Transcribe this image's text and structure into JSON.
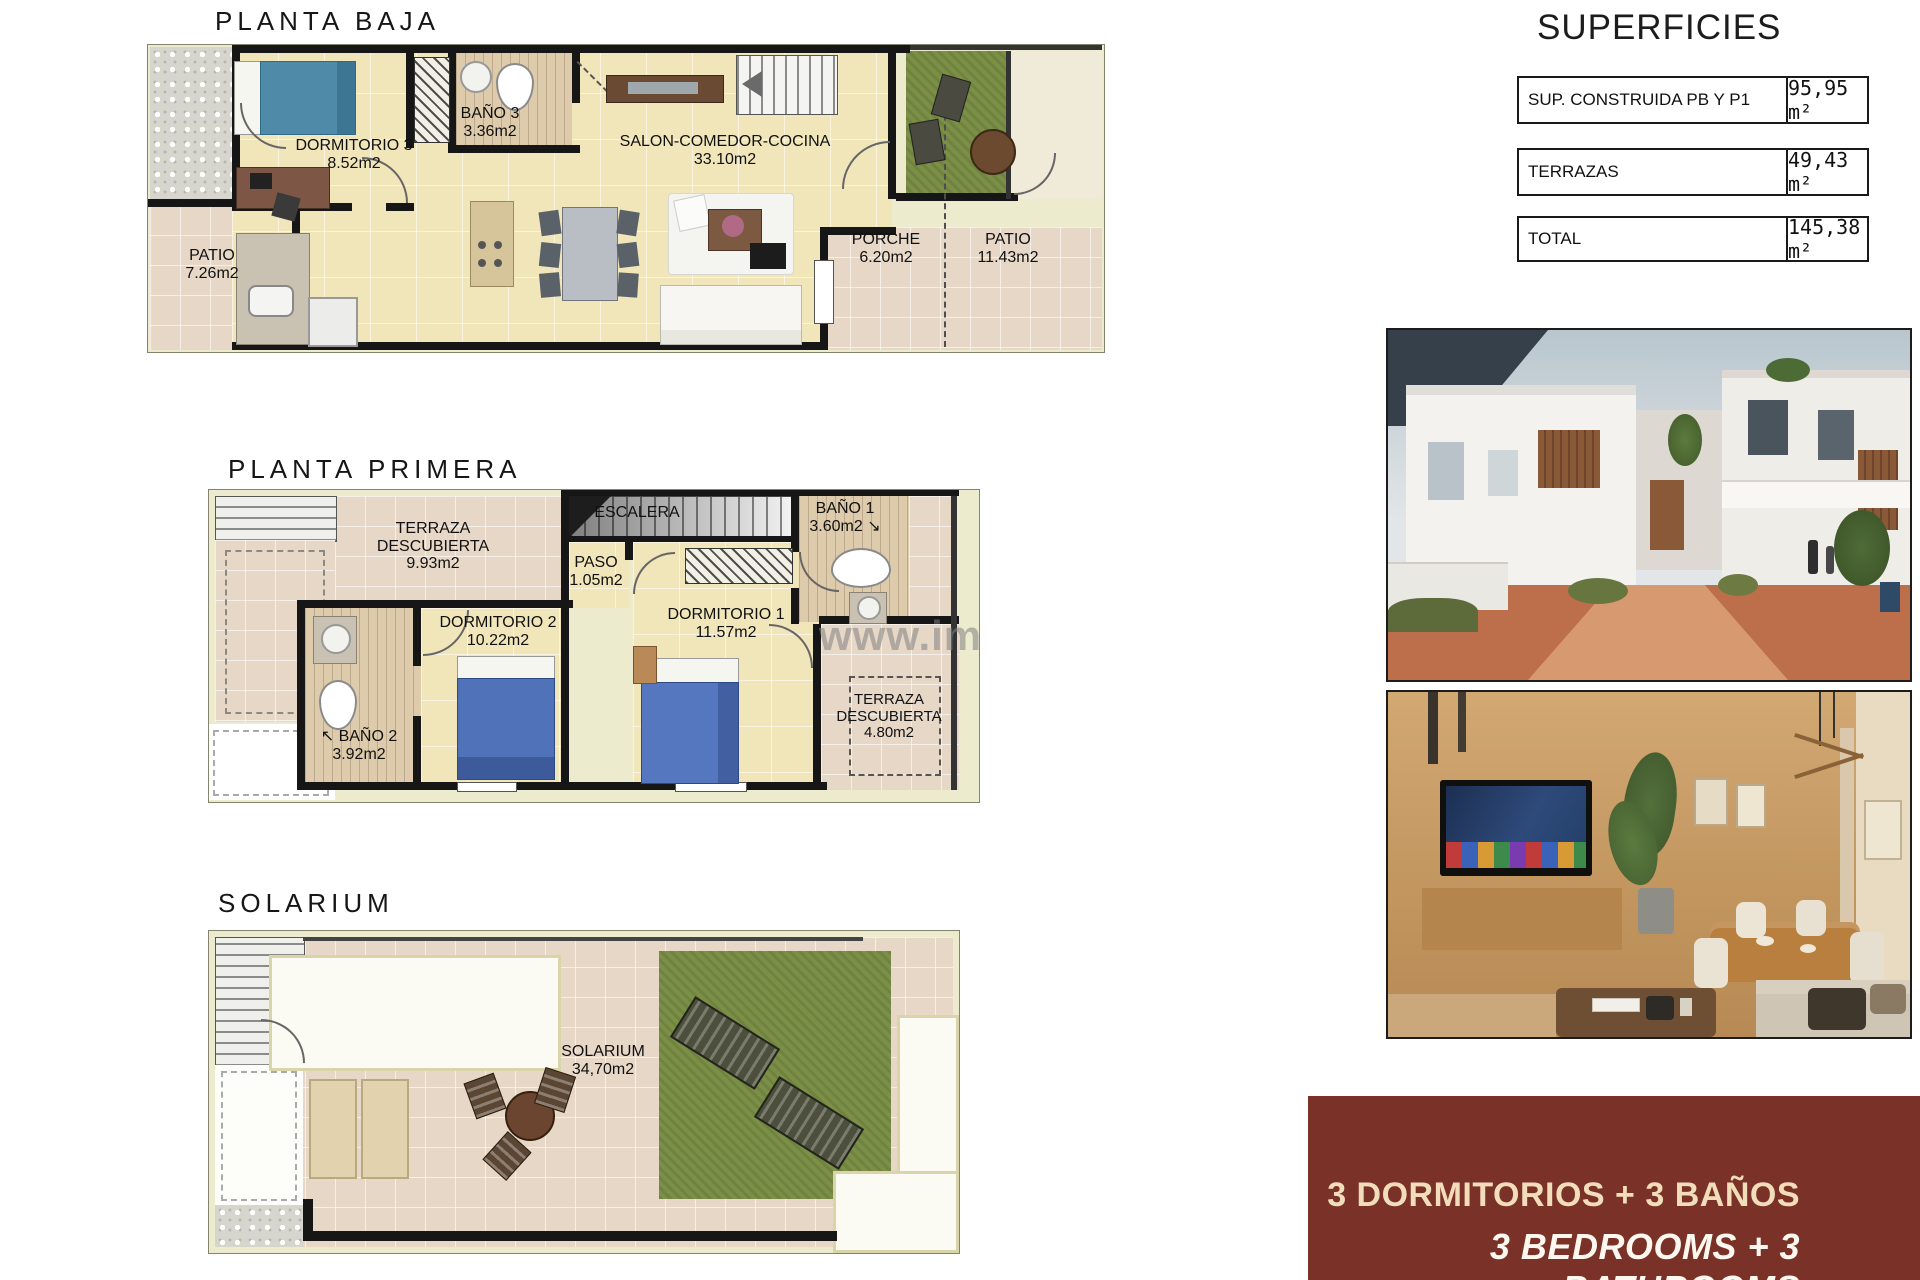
{
  "plans": {
    "planta_baja": {
      "title": "PLANTA BAJA",
      "rooms": {
        "dormitorio3": {
          "name": "DORMITORIO 3",
          "area": "8.52m2"
        },
        "bano3": {
          "name": "BAÑO 3",
          "area": "3.36m2"
        },
        "salon": {
          "name": "SALON-COMEDOR-COCINA",
          "area": "33.10m2"
        },
        "patio_izq": {
          "name": "PATIO",
          "area": "7.26m2"
        },
        "porche": {
          "name": "PORCHE",
          "area": "6.20m2"
        },
        "patio_der": {
          "name": "PATIO",
          "area": "11.43m2"
        }
      }
    },
    "planta_primera": {
      "title": "PLANTA PRIMERA",
      "rooms": {
        "terraza1": {
          "name": "TERRAZA DESCUBIERTA",
          "area": "9.93m2"
        },
        "escalera": {
          "name": "ESCALERA"
        },
        "paso": {
          "name": "PASO",
          "area": "1.05m2"
        },
        "bano1": {
          "name": "BAÑO 1",
          "area": "3.60m2",
          "arrow": "↘"
        },
        "dormitorio2": {
          "name": "DORMITORIO 2",
          "area": "10.22m2"
        },
        "dormitorio1": {
          "name": "DORMITORIO 1",
          "area": "11.57m2"
        },
        "bano2": {
          "name": "BAÑO 2",
          "area": "3.92m2",
          "arrow": "↖"
        },
        "terraza2": {
          "name": "TERRAZA DESCUBIERTA",
          "area": "4.80m2"
        }
      },
      "watermark": "www.imm"
    },
    "solarium": {
      "title": "SOLARIUM",
      "rooms": {
        "solarium": {
          "name": "SOLARIUM",
          "area": "34,70m2"
        }
      }
    }
  },
  "superficies": {
    "title": "SUPERFICIES",
    "rows": [
      {
        "label": "SUP. CONSTRUIDA PB Y P1",
        "value": "95,95 m²"
      },
      {
        "label": "TERRAZAS",
        "value": "49,43 m²"
      },
      {
        "label": "TOTAL",
        "value": "145,38 m²"
      }
    ]
  },
  "banner": {
    "line1": "3 DORMITORIOS + 3 BAÑOS",
    "line2": "3 BEDROOMS + 3 BATHROOMS",
    "background": "#7a3127",
    "line1_color": "#f2ddbb",
    "line2_color": "#fcf8f0"
  },
  "colors": {
    "plan_floor": "#f1e5ba",
    "outdoor_tile": "#e7d7c7",
    "grass": "#7c8f47",
    "wall": "#161616",
    "bed_teal": "#4f8ba8",
    "bed_blue": "#5072b8"
  }
}
